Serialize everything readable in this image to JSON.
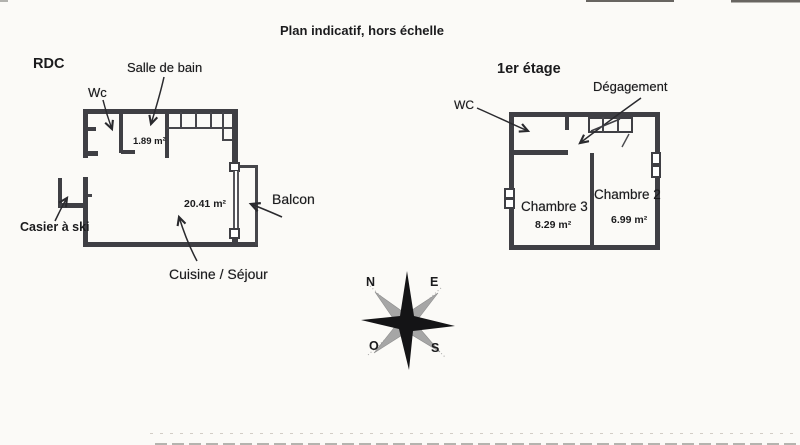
{
  "title": "Plan indicatif, hors échelle",
  "rdc": {
    "label": "RDC",
    "wc_label": "Wc",
    "salle_de_bain_label": "Salle de bain",
    "salle_de_bain_area": "1.89 m²",
    "cuisine_label": "Cuisine / Séjour",
    "cuisine_area": "20.41 m²",
    "balcon_label": "Balcon",
    "casier_label": "Casier à ski"
  },
  "etage": {
    "label": "1er étage",
    "wc_label": "WC",
    "degagement_label": "Dégagement",
    "chambre3_label": "Chambre 3",
    "chambre3_area": "8.29 m²",
    "chambre2_label": "Chambre 2",
    "chambre2_area": "6.99 m²"
  },
  "compass": {
    "north": "N",
    "east": "E",
    "west": "O",
    "south": "S"
  },
  "colors": {
    "paper": "#fbfaf7",
    "wall": "#3f3f44",
    "ink": "#1b1b1d",
    "compass_gray": "#a6a6a6"
  }
}
